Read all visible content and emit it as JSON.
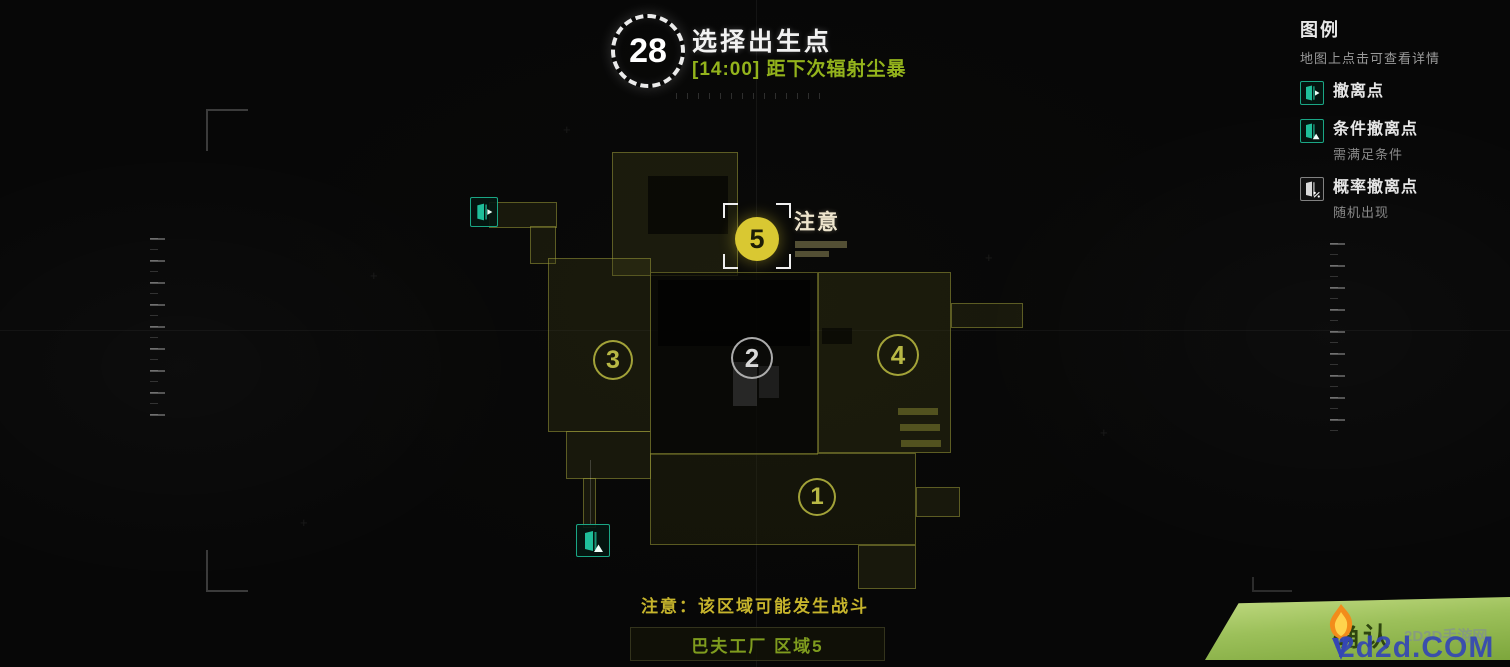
{
  "header": {
    "timer_value": "28",
    "title": "选择出生点",
    "subtitle": "[14:00] 距下次辐射尘暴"
  },
  "legend": {
    "title": "图例",
    "hint": "地图上点击可查看详情",
    "items": [
      {
        "icon": "extraction-door-icon",
        "label": "撤离点",
        "sub": ""
      },
      {
        "icon": "conditional-extraction-door-icon",
        "label": "条件撤离点",
        "sub": "需满足条件"
      },
      {
        "icon": "probability-extraction-door-icon",
        "label": "概率撤离点",
        "sub": "随机出现"
      }
    ]
  },
  "map": {
    "zones": [
      {
        "number": "1"
      },
      {
        "number": "2"
      },
      {
        "number": "3"
      },
      {
        "number": "4"
      }
    ],
    "selected_zone": {
      "number": "5",
      "label": "注意"
    },
    "warning": "注意：该区域可能发生战斗",
    "area_name": "巴夫工厂 区域5"
  },
  "footer": {
    "confirm_label": "确认"
  },
  "watermark": {
    "site": "2d2d.COM",
    "site_name": "2D2D手游网"
  },
  "colors": {
    "subtitle_green": "#93b31c",
    "zone_outline_olive": "#b0b040",
    "zone_selected_yellow": "#d9c832",
    "extraction_teal": "#1fbf9a",
    "warning_yellow": "#c6b42c",
    "area_label_green": "#7f9c1e",
    "confirm_green_top": "#c3dc84",
    "confirm_green_bottom": "#7da63c",
    "watermark_blue": "#3446b4"
  }
}
